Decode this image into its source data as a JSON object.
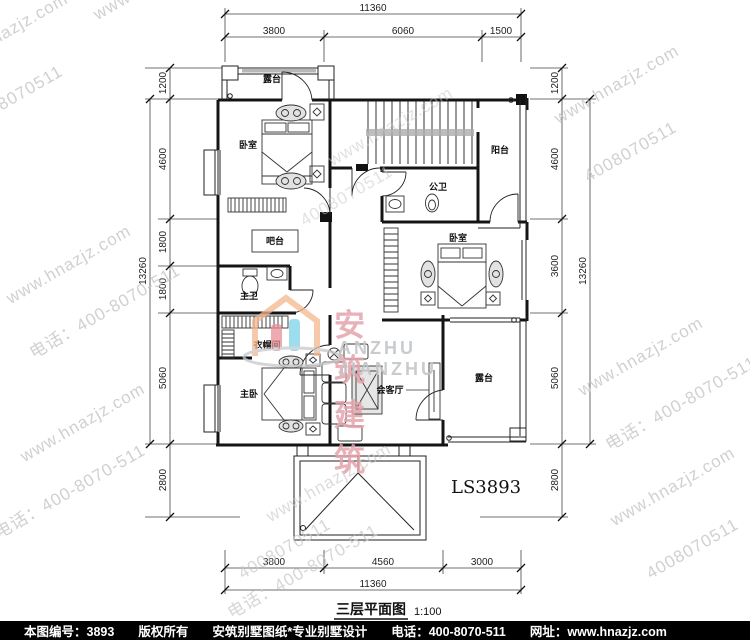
{
  "watermark": {
    "url": "www.hnazjz.com",
    "phone": "电话：400-8070-511",
    "digits": "4008070511"
  },
  "brand": {
    "cn": "安筑建筑",
    "en": "ANZHU JIANZHU"
  },
  "plan_code": "LS3893",
  "title": {
    "name": "三层平面图",
    "scale": "1:100"
  },
  "dimensions": {
    "top": {
      "total": "11360",
      "segments": [
        "3800",
        "6060",
        "1500"
      ]
    },
    "bottom": {
      "total": "11360",
      "segments": [
        "3800",
        "4560",
        "3000"
      ]
    },
    "left": {
      "total": "13260",
      "segments": [
        "1200",
        "4600",
        "1800",
        "1800",
        "5060",
        "2800"
      ]
    },
    "right": {
      "total": "13260",
      "segments": [
        "1200",
        "4600",
        "3600",
        "5060",
        "2800"
      ]
    }
  },
  "rooms": {
    "terrace_top": "露台",
    "bedroom_nw": "卧室",
    "balcony_e": "阳台",
    "bath_public": "公卫",
    "bar": "吧台",
    "bath_master": "主卫",
    "cloakroom": "衣帽间",
    "bedroom_e": "卧室",
    "bedroom_master": "主卧",
    "family_room": "会客厅",
    "terrace_se": "露台"
  },
  "footer": {
    "no": "本图编号：3893",
    "copyright": "版权所有",
    "slogan": "安筑别墅图纸*专业别墅设计",
    "phone": "电话：400-8070-511",
    "site": "网址：www.hnazjz.com"
  }
}
